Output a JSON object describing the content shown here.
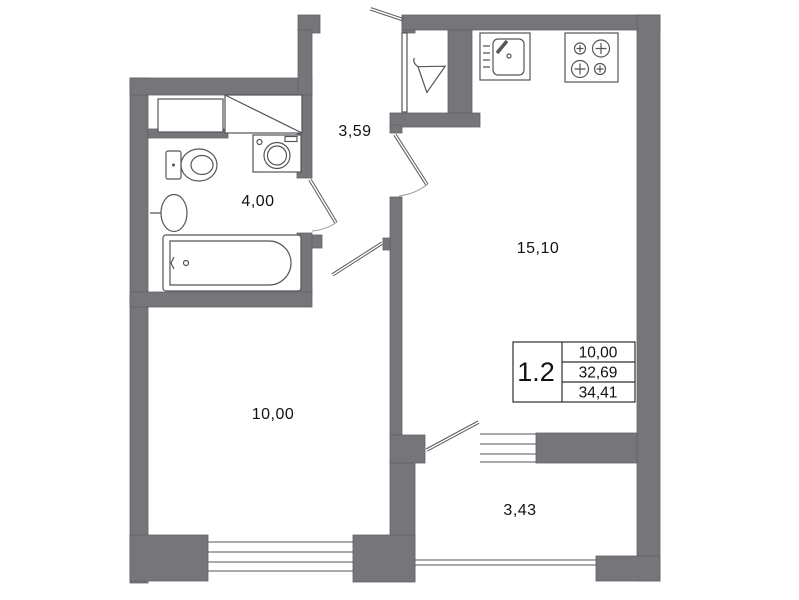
{
  "plan": {
    "apartment_number": "1.2",
    "info_table": {
      "rows": [
        "10,00",
        "32,69",
        "34,41"
      ]
    },
    "rooms": [
      {
        "id": "hallway",
        "area_label": "3,59"
      },
      {
        "id": "bathroom",
        "area_label": "4,00"
      },
      {
        "id": "kitchen-living",
        "area_label": "15,10"
      },
      {
        "id": "bedroom",
        "area_label": "10,00"
      },
      {
        "id": "balcony",
        "area_label": "3,43"
      }
    ],
    "colors": {
      "wall": "#76767a",
      "outline": "#555555",
      "text": "#111111",
      "background": "#ffffff"
    }
  }
}
